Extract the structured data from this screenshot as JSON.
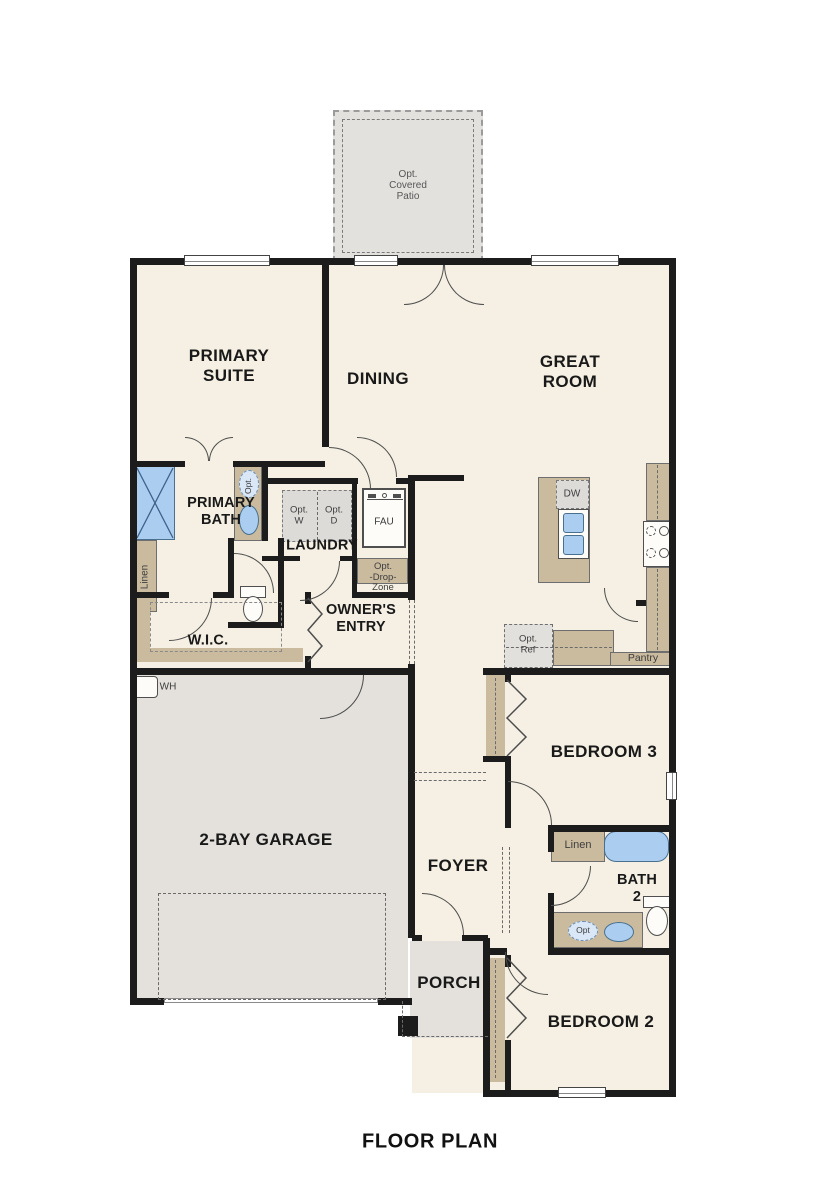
{
  "title": "FLOOR PLAN",
  "patio": {
    "line1": "Opt.",
    "line2": "Covered",
    "line3": "Patio"
  },
  "rooms": {
    "primary_suite": {
      "line1": "PRIMARY",
      "line2": "SUITE"
    },
    "dining": {
      "label": "DINING"
    },
    "great_room": {
      "line1": "GREAT",
      "line2": "ROOM"
    },
    "primary_bath": {
      "line1": "PRIMARY",
      "line2": "BATH"
    },
    "laundry": {
      "label": "LAUNDRY"
    },
    "wic": {
      "label": "W.I.C."
    },
    "owners_entry": {
      "line1": "OWNER'S",
      "line2": "ENTRY"
    },
    "bedroom3": {
      "label": "BEDROOM 3"
    },
    "garage": {
      "label": "2-BAY GARAGE"
    },
    "foyer": {
      "label": "FOYER"
    },
    "bath2": {
      "line1": "BATH",
      "line2": "2"
    },
    "bedroom2": {
      "label": "BEDROOM 2"
    },
    "porch": {
      "label": "PORCH"
    }
  },
  "fixtures": {
    "opt_washer": {
      "line1": "Opt.",
      "line2": "W"
    },
    "opt_dryer": {
      "line1": "Opt.",
      "line2": "D"
    },
    "fau": {
      "label": "FAU"
    },
    "opt_drop_zone": {
      "line1": "Opt.",
      "line2": "-Drop-",
      "line3": "Zone"
    },
    "linen_primary": {
      "label": "Linen"
    },
    "linen_bath2": {
      "label": "Linen"
    },
    "dishwasher": {
      "label": "DW"
    },
    "opt_ref": {
      "line1": "Opt.",
      "line2": "Ref"
    },
    "pantry": {
      "label": "Pantry"
    },
    "water_heater": {
      "label": "WH"
    },
    "opt_sink_primary": {
      "label": "Opt."
    },
    "opt_sink_bath2": {
      "label": "Opt"
    }
  },
  "colors": {
    "wall": "#1c1c1c",
    "floor": "#f5f0e3",
    "garage_floor": "#e4e1dd",
    "counter": "#cabb9f",
    "fixture_blue": "#aacdf0",
    "optional_fill": "#dedcd9"
  }
}
